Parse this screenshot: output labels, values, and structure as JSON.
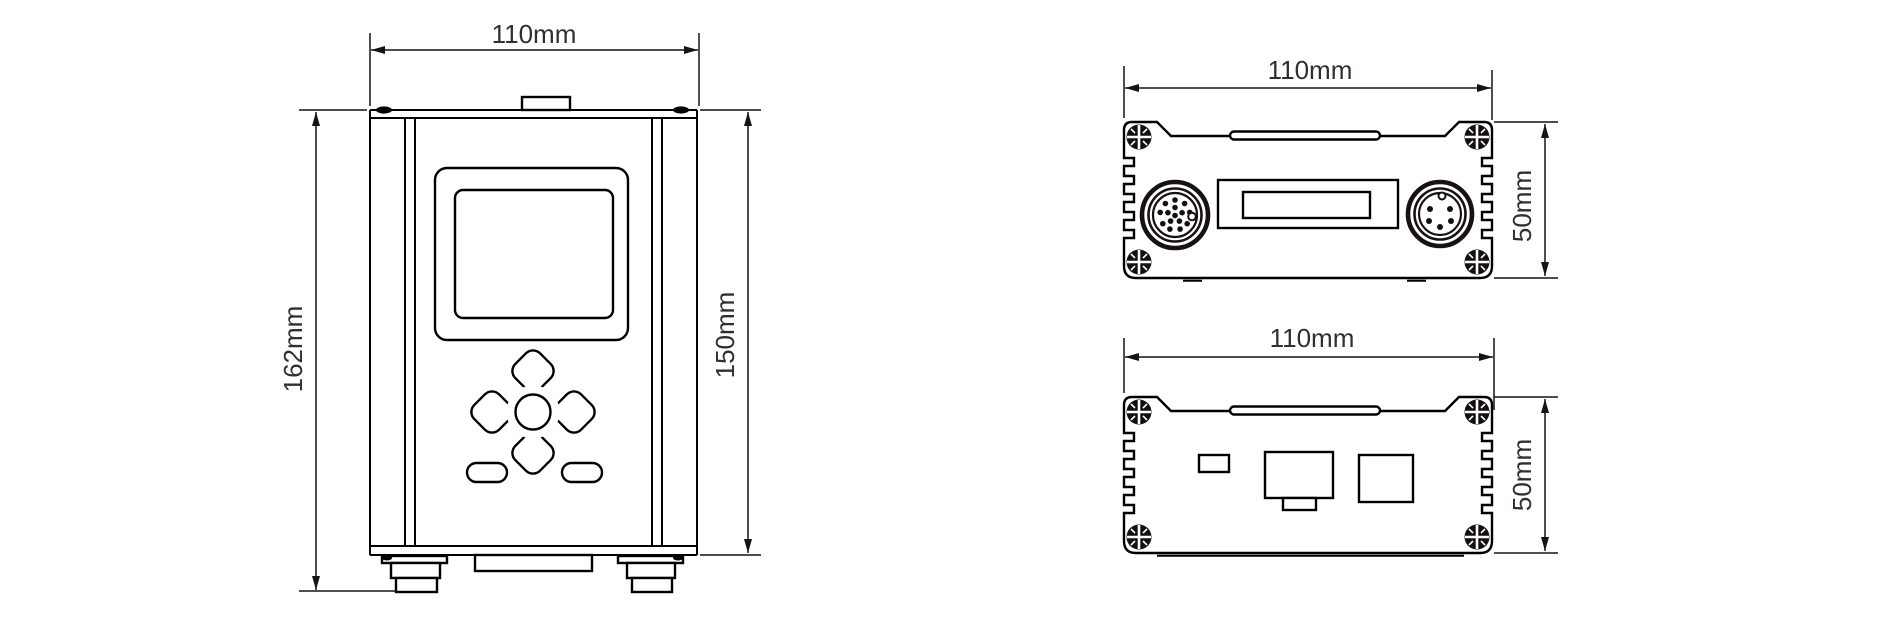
{
  "page": {
    "background_color": "#ffffff",
    "line_color": "#000000",
    "dimension_text_color": "#332e2b"
  },
  "drawing": {
    "front_view": {
      "width_label": "110mm",
      "total_height_label": "162mm",
      "body_height_label": "150mm"
    },
    "top_view": {
      "width_label": "110mm",
      "depth_label": "50mm"
    },
    "bottom_view": {
      "width_label": "110mm",
      "depth_label": "50mm"
    }
  }
}
